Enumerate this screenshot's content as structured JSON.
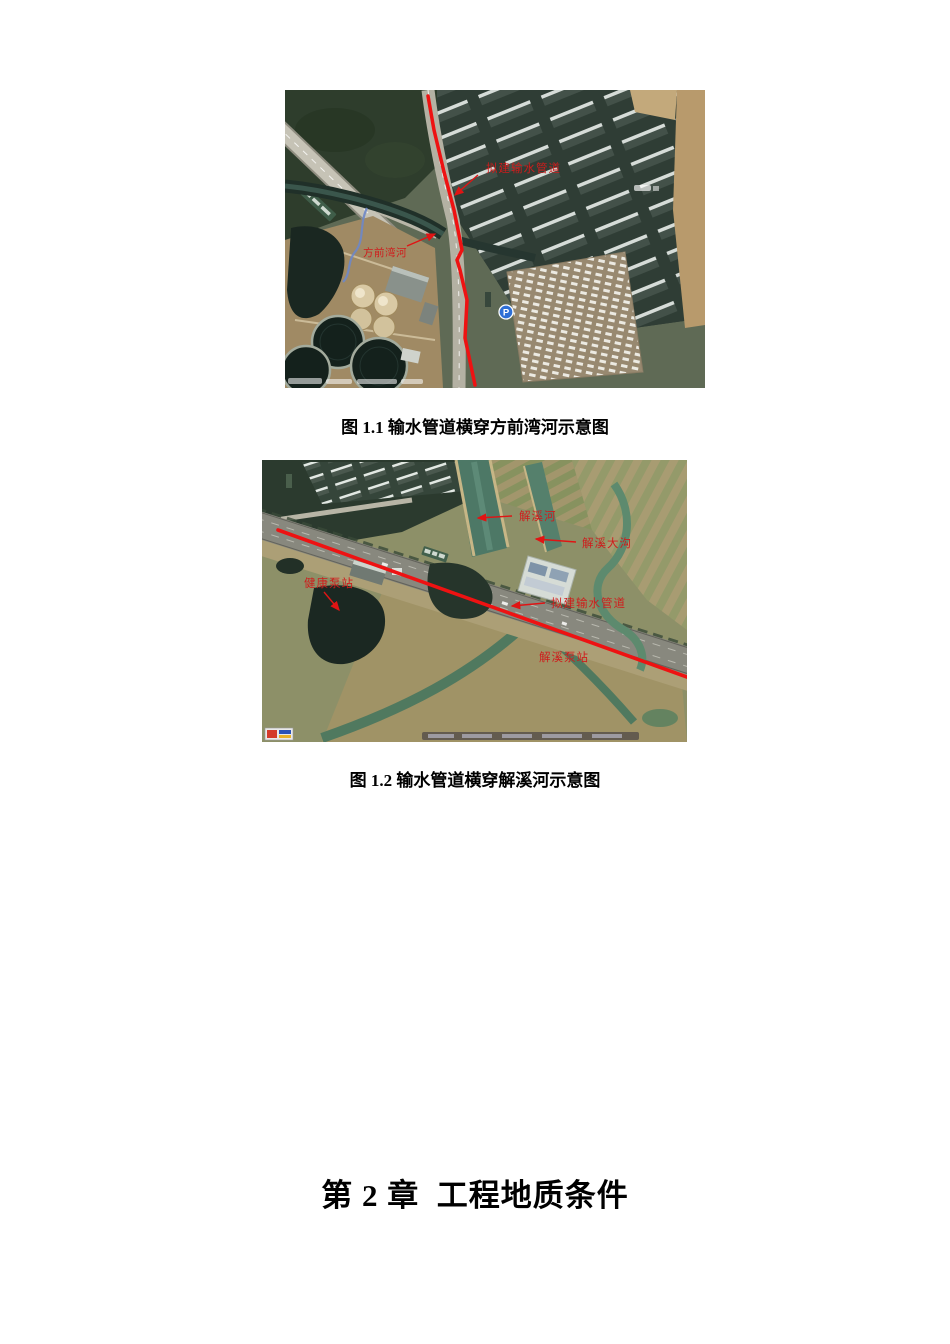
{
  "figures": {
    "fig1": {
      "caption": "图 1.1 输水管道横穿方前湾河示意图",
      "labels": {
        "pipeline": "拟建输水管道",
        "river": "方前湾河",
        "parking": "P"
      }
    },
    "fig2": {
      "caption": "图 1.2 输水管道横穿解溪河示意图",
      "labels": {
        "river": "解溪河",
        "ditch": "解溪大沟",
        "health_pump": "健康泵站",
        "pipeline": "拟建输水管道",
        "jiexi_pump": "解溪泵站"
      }
    }
  },
  "heading": "第 2 章  工程地质条件",
  "colors": {
    "annotation_red": "#cf1c1c",
    "route_red": "#ee1212"
  }
}
